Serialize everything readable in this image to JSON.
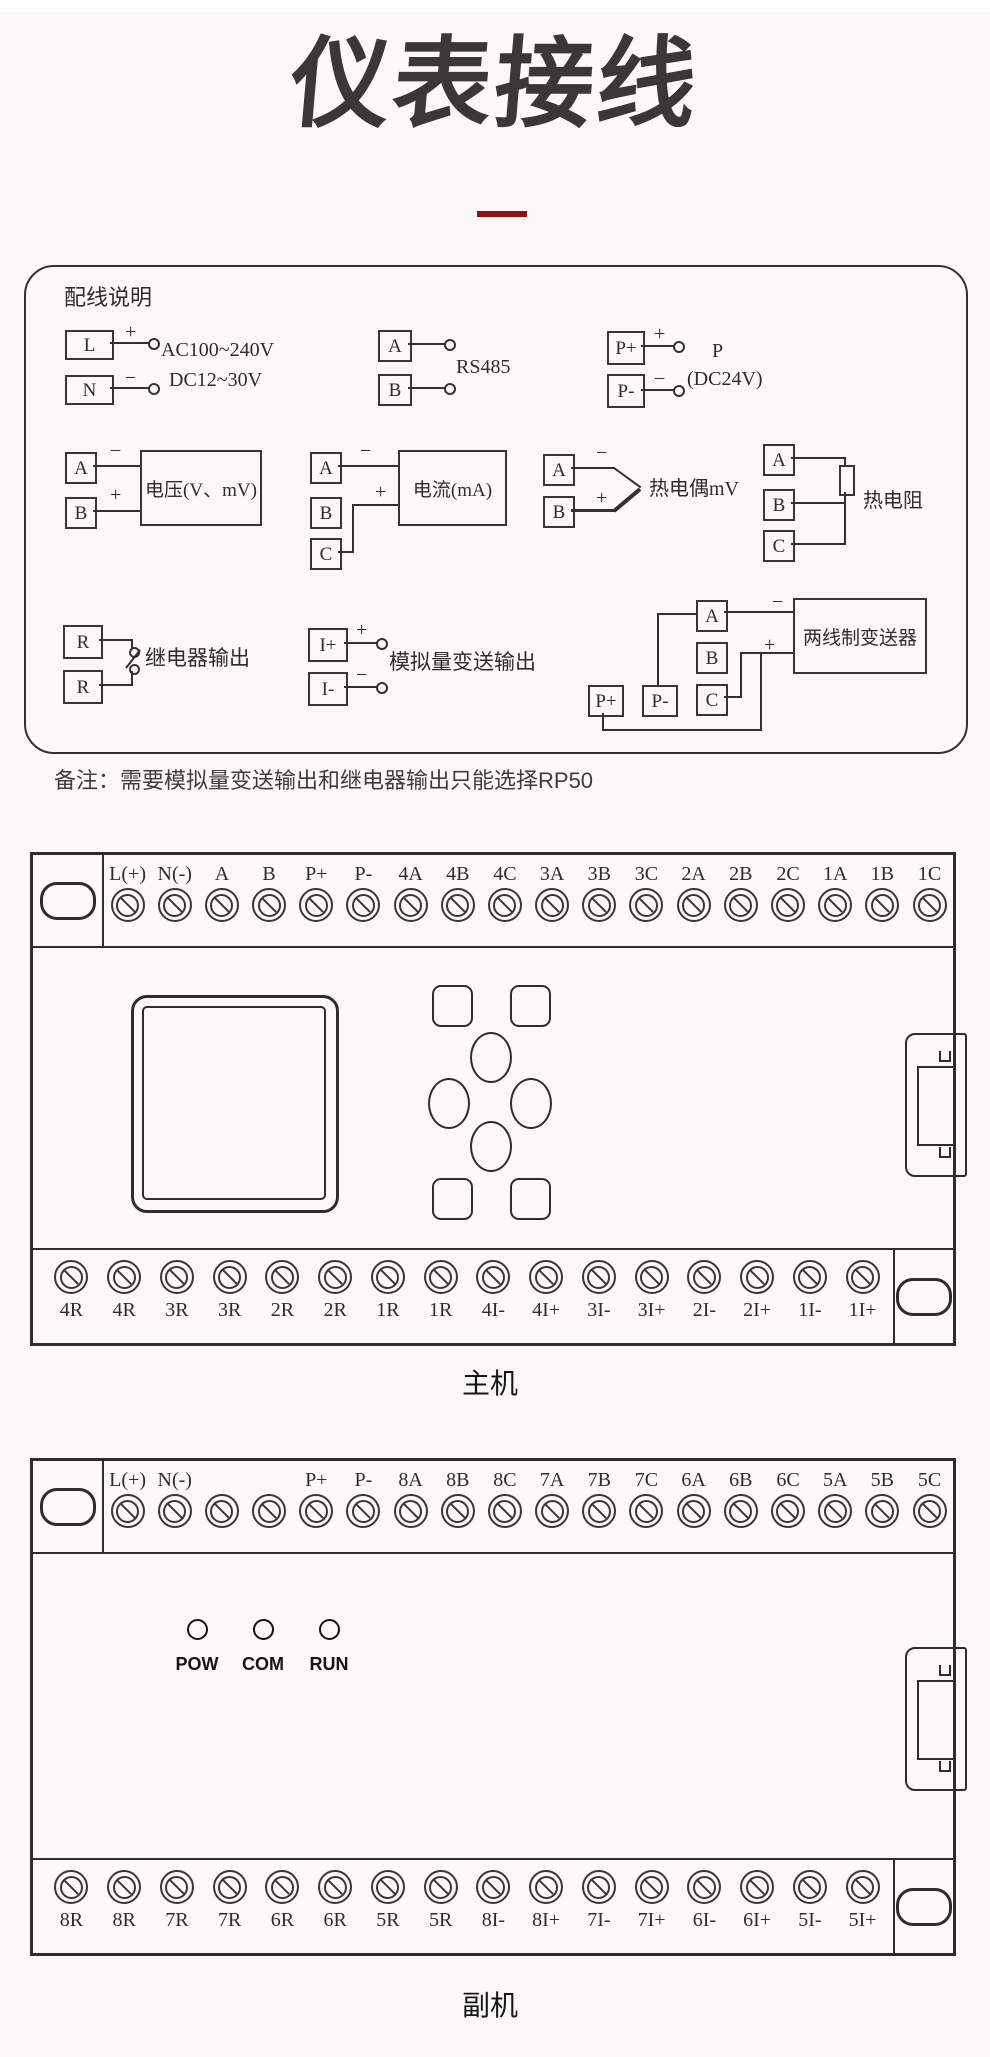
{
  "page": {
    "title": "仪表接线",
    "note": "备注：需要模拟量变送输出和继电器输出只能选择RP50",
    "accent_red": "#8e1212"
  },
  "wiring_box": {
    "heading": "配线说明",
    "power": {
      "t1": "L",
      "t2": "N",
      "plus": "+",
      "minus": "−",
      "volt1": "AC100~240V",
      "volt2": "DC12~30V"
    },
    "rs485": {
      "t1": "A",
      "t2": "B",
      "label": "RS485"
    },
    "aux_power": {
      "t1": "P+",
      "t2": "P-",
      "plus": "+",
      "minus": "−",
      "name": "P",
      "spec": "(DC24V)"
    },
    "voltage": {
      "t1": "A",
      "t2": "B",
      "plus": "+",
      "minus": "−",
      "label": "电压(V、mV)"
    },
    "current": {
      "t1": "A",
      "t2": "B",
      "t3": "C",
      "plus": "+",
      "minus": "−",
      "label": "电流(mA)"
    },
    "thermocouple": {
      "t1": "A",
      "t2": "B",
      "plus": "+",
      "minus": "−",
      "label": "热电偶mV"
    },
    "rtd": {
      "t1": "A",
      "t2": "B",
      "t3": "C",
      "label": "热电阻"
    },
    "relay": {
      "t1": "R",
      "t2": "R",
      "label": "继电器输出"
    },
    "analog_output": {
      "t1": "I+",
      "t2": "I-",
      "plus": "+",
      "minus": "−",
      "label": "模拟量变送输出"
    },
    "transmitter": {
      "t1": "A",
      "t2": "B",
      "t3": "C",
      "p1": "P+",
      "p2": "P-",
      "plus": "+",
      "minus": "−",
      "label": "两线制变送器"
    }
  },
  "main_unit": {
    "caption": "主机",
    "top_labels": [
      "L(+)",
      "N(-)",
      "A",
      "B",
      "P+",
      "P-",
      "4A",
      "4B",
      "4C",
      "3A",
      "3B",
      "3C",
      "2A",
      "2B",
      "2C",
      "1A",
      "1B",
      "1C"
    ],
    "bottom_labels": [
      "4R",
      "4R",
      "3R",
      "3R",
      "2R",
      "2R",
      "1R",
      "1R",
      "4I-",
      "4I+",
      "3I-",
      "3I+",
      "2I-",
      "2I+",
      "1I-",
      "1I+"
    ]
  },
  "aux_unit": {
    "caption": "副机",
    "top_labels": [
      "L(+)",
      "N(-)",
      "",
      "",
      "P+",
      "P-",
      "8A",
      "8B",
      "8C",
      "7A",
      "7B",
      "7C",
      "6A",
      "6B",
      "6C",
      "5A",
      "5B",
      "5C"
    ],
    "bottom_labels": [
      "8R",
      "8R",
      "7R",
      "7R",
      "6R",
      "6R",
      "5R",
      "5R",
      "8I-",
      "8I+",
      "7I-",
      "7I+",
      "6I-",
      "6I+",
      "5I-",
      "5I+"
    ],
    "leds": [
      "POW",
      "COM",
      "RUN"
    ]
  }
}
